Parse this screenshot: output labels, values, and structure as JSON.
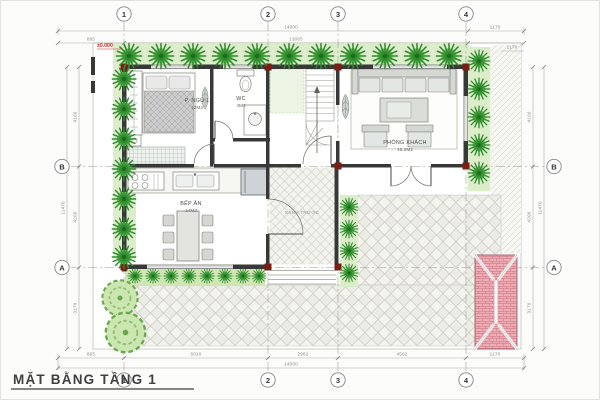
{
  "title": "MẶT BẰNG TẦNG 1",
  "rooms": {
    "bedroom": {
      "name": "P. NGỦ 1",
      "area": "12M2"
    },
    "wc": {
      "name": "WC",
      "area": "4M2"
    },
    "living": {
      "name": "PHÒNG KHÁCH",
      "area": "16.2M2"
    },
    "kitchen": {
      "name": "BẾP ĂN",
      "area": "14M2"
    },
    "porch": {
      "name": "SẢNH TRƯỚC"
    }
  },
  "grid": {
    "cols": [
      "1",
      "2",
      "3",
      "4"
    ],
    "rows": [
      "B",
      "A"
    ]
  },
  "dims": {
    "top_overall": "14000",
    "top_left": "865",
    "top_mid": "13065",
    "top_right": "1170",
    "bottom": [
      "865",
      "5010",
      "2982",
      "4502",
      "1170"
    ],
    "bottom_overall": "14000",
    "side": [
      "4100",
      "4200",
      "3170"
    ],
    "side_overall": "11470",
    "right_small": "1170"
  },
  "annotations": {
    "level_mark": "±0.000"
  },
  "colors": {
    "tree_green": "#3f9e3f",
    "hedge_bg": "#dcedca",
    "wall": "#383838",
    "column_red": "#7a1d12",
    "gate_pink": "#efaeb6",
    "dim_gray": "#8a8a84",
    "level_red": "#c8281e"
  }
}
